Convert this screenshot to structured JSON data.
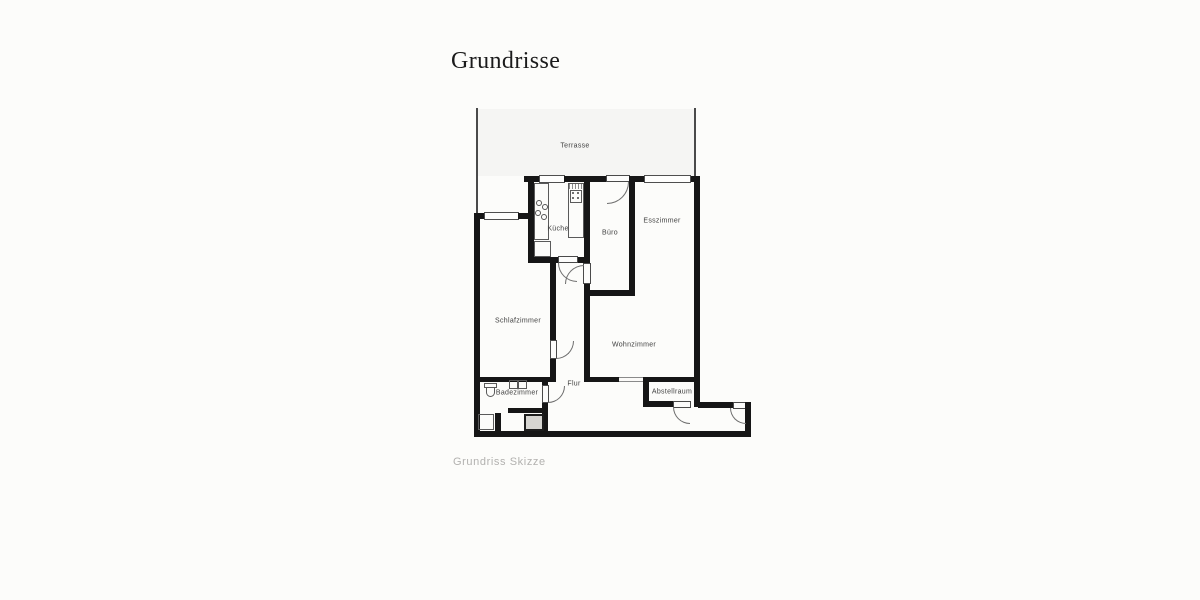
{
  "page": {
    "title": "Grundrisse",
    "caption": "Grundriss Skizze"
  },
  "floorplan": {
    "rooms": [
      {
        "id": "terrasse",
        "label": "Terrasse"
      },
      {
        "id": "kueche",
        "label": "Küche"
      },
      {
        "id": "buero",
        "label": "Büro"
      },
      {
        "id": "esszimmer",
        "label": "Esszimmer"
      },
      {
        "id": "schlafzimmer",
        "label": "Schlafzimmer"
      },
      {
        "id": "wohnzimmer",
        "label": "Wohnzimmer"
      },
      {
        "id": "flur",
        "label": "Flur"
      },
      {
        "id": "badezimmer",
        "label": "Badezimmer"
      },
      {
        "id": "abstellraum",
        "label": "Abstellraum"
      }
    ],
    "colors": {
      "wall": "#161616",
      "paper": "#fcfcfa",
      "line": "#555555",
      "label": "#3f3f3f",
      "caption": "#b2b1af",
      "title": "#1b1b1b"
    }
  }
}
